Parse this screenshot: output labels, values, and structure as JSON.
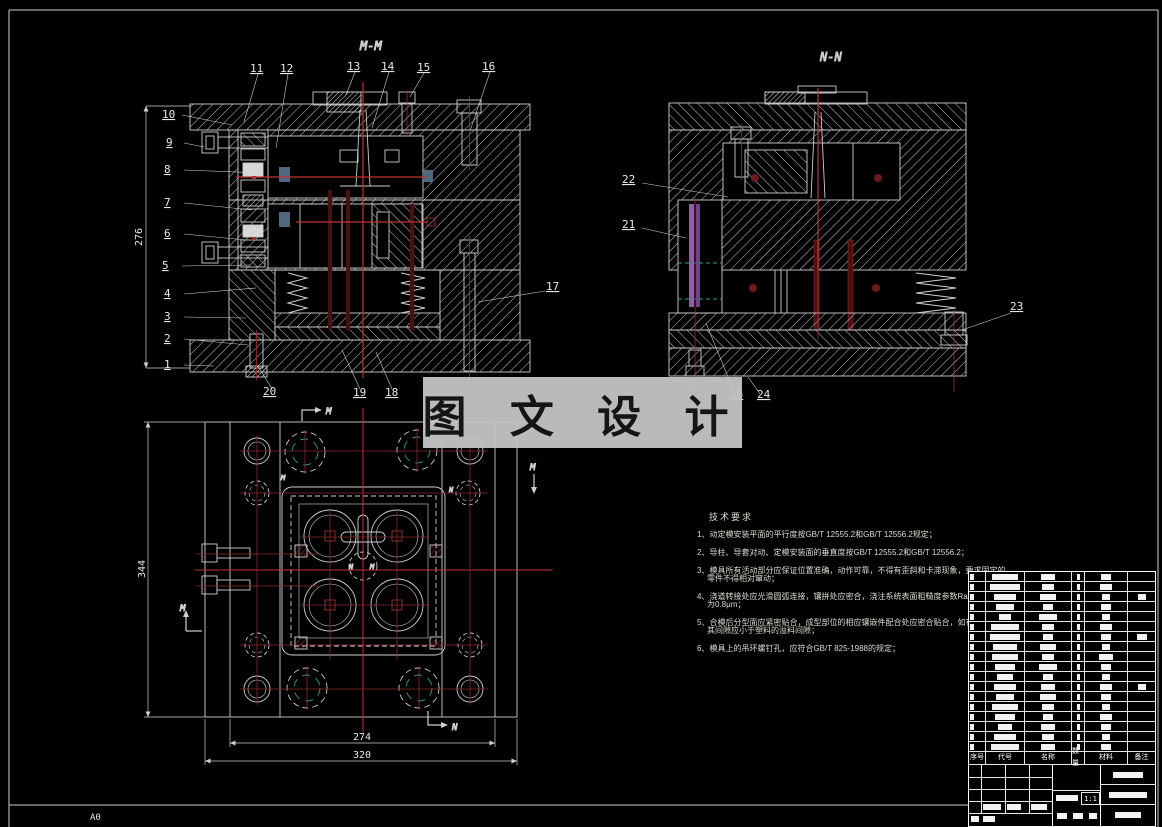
{
  "sheet": {
    "size_label": "A0",
    "scale": "1:1"
  },
  "views": {
    "mm": {
      "label": "M-M"
    },
    "nn": {
      "label": "N-N"
    },
    "plan": {
      "marker_m": "M",
      "marker_n": "N"
    }
  },
  "callouts": {
    "left": [
      "10",
      "9",
      "8",
      "7",
      "6",
      "5",
      "4",
      "3",
      "2",
      "1"
    ],
    "top": [
      "11",
      "12",
      "13",
      "14",
      "15",
      "16"
    ],
    "right": [
      "17"
    ],
    "bottom": [
      "20",
      "19",
      "18"
    ],
    "nn_left": [
      "22",
      "21"
    ],
    "nn_right": [
      "23"
    ],
    "nn_bottom": [
      "25",
      "24"
    ]
  },
  "dims": {
    "mm_height": "276",
    "plan_height": "344",
    "plan_inner_width": "274",
    "plan_outer_width": "320"
  },
  "watermark": {
    "text": "图 文 设 计"
  },
  "tech": {
    "title": "技术要求",
    "lines": [
      "1、动定模安装平面的平行度按GB/T 12555.2和GB/T 12556.2规定；",
      "2、导柱、导套对动、定模安装面的垂直度按GB/T 12555.2和GB/T 12556.2；",
      "3、模具所有活动部分应保证位置准确，动作可靠，不得有歪斜和卡滞现象，要求固定的",
      "零件不得相对窜动；",
      "4、浇道转接处应光滑圆弧连接，镶拼处应密合，浇注系统表面粗糙度参数Ra的最大允许值",
      "为0.8μm；",
      "5、合模后分型面应紧密贴合，成型部位的相应镶嵌件配合处应密合贴合，如有局部间隙，",
      "其间隙应小于塑料的溢料间隙；",
      "6、模具上的吊环螺钉孔，应符合GB/T 825-1988的规定；"
    ]
  },
  "bom": {
    "headers": [
      "序号",
      "代号",
      "名称",
      "数量",
      "材料",
      "备注"
    ],
    "scale": "1:1"
  }
}
